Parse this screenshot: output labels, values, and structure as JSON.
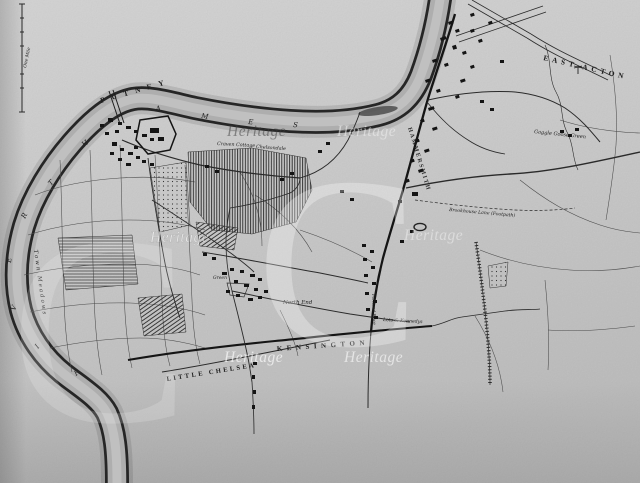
{
  "artifact": {
    "kind": "scanned antique engraved map print",
    "region": "Thames bend at Fulham with Putney, Hammersmith, Kensington and East Acton"
  },
  "map": {
    "scale_label": "One Mile",
    "places": {
      "putney": "PUTNEY",
      "east_acton": "EAST ACTON",
      "kensington": "KENSINGTON",
      "little_chelsea": "LITTLE CHELSEA",
      "hammersmith": "HAMMERSMITH"
    },
    "river": {
      "name": "RIVER THAMES",
      "letters": [
        "R",
        "I",
        "V",
        "E",
        "R",
        "T",
        "H",
        "A",
        "M",
        "E",
        "S"
      ]
    },
    "minor_labels": {
      "town_meadows": "Town Meadows",
      "north_end": "North End",
      "gaggle_goose_green": "Gaggle Goose Green",
      "craven_cottage": "Craven Cottage",
      "chelsondale": "Chelsondale",
      "brookhouse_lane": "Brookhouse Lane (Footpath)",
      "lots_kennedys": "Lots & Kennedys",
      "green": "Green",
      "portland_place": "Portland Place"
    },
    "watermark": {
      "text": "Heritage",
      "logo_letter": "C"
    },
    "colors": {
      "paper": "#cdcdcd",
      "ink": "#1e1e1e",
      "water": "#b0b0b0",
      "watermark": "#ffffff"
    }
  }
}
